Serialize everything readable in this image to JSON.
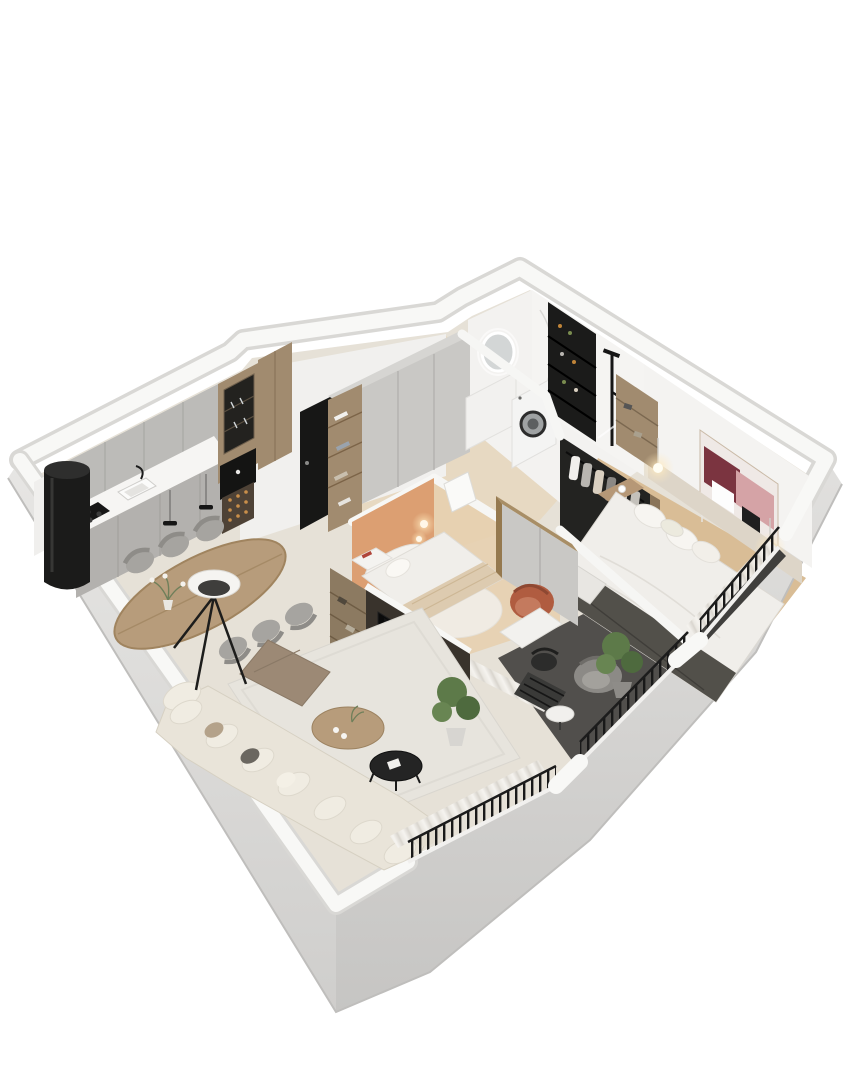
{
  "meta": {
    "title": "3D dollhouse floor plan render of a two-bedroom apartment",
    "view": "isometric cutaway seen from above, white background, no text labels"
  },
  "colors": {
    "page_bg": "#ffffff",
    "wall_top": "#f8f8f6",
    "wall_edge": "#d9d8d5",
    "wall_inner": "#f0efed",
    "floor_main": "#e6e1d7",
    "floor_corridor": "#e7d8c0",
    "floor_bedroom2": "#e6cfae",
    "floor_master": "#d9bd96",
    "floor_terrace": "#514f4c",
    "marble": "#f3f2f0",
    "cabinet_grey": "#bcbbb8",
    "cabinet_grey_dark": "#b3b1ae",
    "counter_white": "#f6f5f3",
    "wood": "#a18b6f",
    "wood_dark": "#8a7459",
    "black": "#171717",
    "wardrobe_grey": "#c9c8c5",
    "closet_black": "#232321",
    "bed_white": "#f0eeea",
    "runner_dark": "#52504a",
    "accent_orange": "#dc9f72",
    "sofa_cream": "#e9e4d9",
    "cushion_cream": "#f0ece2",
    "ottoman_taupe": "#9c8975",
    "table_wood": "#b79c7b",
    "chair_grey": "#a6a4a0",
    "tv_black": "#0b0b0b",
    "media_dark": "#39332c",
    "shelf_wood": "#8c7a61",
    "plant_green": "#5d7a49",
    "plant_green_dark": "#4e6a3e",
    "armchair_rust": "#b05c40",
    "railing_black": "#191919",
    "art_maroon": "#7b3440",
    "art_pink": "#d5a3a6",
    "glow_warm": "#ffe9bd"
  },
  "rooms": [
    {
      "id": "kitchen",
      "name": "Kitchen",
      "furniture": [
        "black cylindrical column",
        "grey upper cabinets",
        "white countertop with sink and black faucet",
        "black cooktop",
        "tall wood cabinet with dark glass display and stemware",
        "built-in black coffee machine",
        "wine rack with bottles"
      ]
    },
    {
      "id": "dining-area",
      "name": "Dining area",
      "furniture": [
        "oval wood dining table",
        "six grey upholstered chairs",
        "bowl of red fruit",
        "flower vase",
        "two small black pendant lights",
        "tripod floor lamp with white shade"
      ]
    },
    {
      "id": "living-room",
      "name": "Living room",
      "furniture": [
        "large cream corner sofa with pillows",
        "taupe square ottoman",
        "round wood coffee table",
        "round black nesting table",
        "light grey rug",
        "potted green plant",
        "TV media wall with black screen",
        "wood open shelving with books"
      ]
    },
    {
      "id": "entrance-hall",
      "name": "Entrance hall",
      "furniture": [
        "black entrance door",
        "grey wardrobe with wood open shelves and folded clothes"
      ]
    },
    {
      "id": "bathroom",
      "name": "Bathroom / laundry",
      "furniture": [
        "round backlit mirror",
        "white vanity",
        "washing machine with round door",
        "black storage shelf with bottles",
        "black shower fixture",
        "marble walls"
      ]
    },
    {
      "id": "walk-in-closet",
      "name": "Walk-in closet",
      "furniture": [
        "black open wardrobe with hanging clothes"
      ]
    },
    {
      "id": "master-bedroom",
      "name": "Master bedroom",
      "furniture": [
        "double bed with white bedding and dark grey runner",
        "beige headboard wall",
        "abstract wall art in maroon and pink",
        "two glowing pendant lights",
        "wood bedside shelf with coffee cup",
        "wood open shelf unit",
        "white curtains"
      ]
    },
    {
      "id": "second-bedroom",
      "name": "Second bedroom",
      "furniture": [
        "terracotta accent wall",
        "single bed with beige throw",
        "glowing wall lamp",
        "white nightstand with magazines",
        "wardrobe with wood frame",
        "rust armchair",
        "white round rug",
        "white desk with black chair"
      ]
    },
    {
      "id": "terrace",
      "name": "Terrace",
      "furniture": [
        "grey lounge chair",
        "black slatted chair",
        "round white side table",
        "potted plant",
        "black railing"
      ]
    },
    {
      "id": "french-balcony",
      "name": "French balcony",
      "furniture": [
        "black railing",
        "dark floor strip"
      ]
    }
  ]
}
